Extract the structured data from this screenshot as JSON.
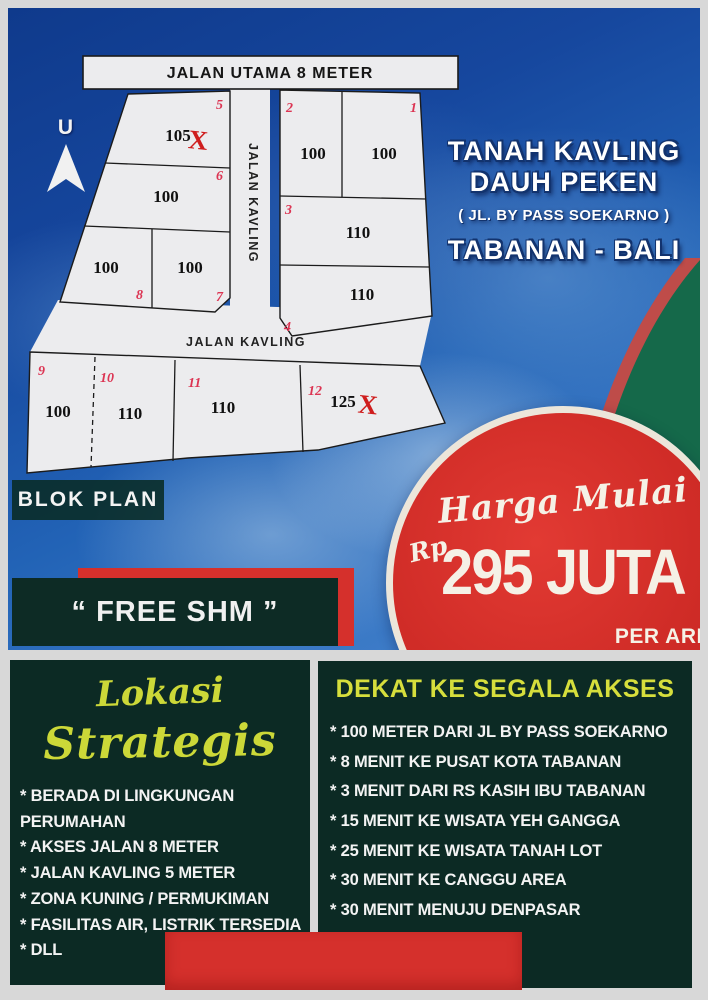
{
  "map": {
    "north_label": "U",
    "main_road_label": "JALAN UTAMA 8 METER",
    "vertical_road_label": "JALAN KAVLING",
    "horizontal_road_label": "JALAN KAVLING",
    "blok_plan_label": "BLOK PLAN",
    "sold_mark": "X",
    "plots": [
      {
        "id": "1",
        "area": "100",
        "sold": false
      },
      {
        "id": "2",
        "area": "100",
        "sold": false
      },
      {
        "id": "3",
        "area": "110",
        "sold": false
      },
      {
        "id": "4",
        "area": "110",
        "sold": false
      },
      {
        "id": "5",
        "area": "105",
        "sold": true
      },
      {
        "id": "6",
        "area": "100",
        "sold": false
      },
      {
        "id": "7",
        "area": "100",
        "sold": false
      },
      {
        "id": "8",
        "area": "100",
        "sold": false
      },
      {
        "id": "9",
        "area": "100",
        "sold": false
      },
      {
        "id": "10",
        "area": "110",
        "sold": false
      },
      {
        "id": "11",
        "area": "110",
        "sold": false
      },
      {
        "id": "12",
        "area": "125",
        "sold": true
      }
    ]
  },
  "headline": {
    "line1": "TANAH KAVLING",
    "line2": "DAUH PEKEN",
    "line3": "( JL. BY PASS SOEKARNO )",
    "line4": "TABANAN - BALI"
  },
  "price": {
    "lead": "Harga Mulai",
    "currency": "Rp",
    "amount": "295 JUTA",
    "unit": "PER ARE"
  },
  "free_shm_label": "“ FREE SHM ”",
  "left_panel": {
    "heading_line1": "Lokasi",
    "heading_line2": "Strategis",
    "items": [
      "* BERADA DI LINGKUNGAN PERUMAHAN",
      "* AKSES JALAN 8 METER",
      "* JALAN KAVLING 5 METER",
      "* ZONA KUNING / PERMUKIMAN",
      "* FASILITAS AIR, LISTRIK TERSEDIA",
      "* DLL"
    ]
  },
  "right_panel": {
    "heading": "DEKAT KE SEGALA AKSES",
    "items": [
      "* 100 METER DARI JL BY PASS SOEKARNO",
      "* 8 MENIT KE PUSAT KOTA TABANAN",
      "* 3 MENIT DARI RS KASIH IBU TABANAN",
      "* 15 MENIT KE WISATA YEH GANGGA",
      "* 25 MENIT KE WISATA TANAH LOT",
      "* 30 MENIT KE CANGGU AREA",
      "* 30 MENIT MENUJU DENPASAR"
    ]
  },
  "colors": {
    "accent_red": "#d5302c",
    "panel_green": "#0c2a24",
    "ribbon_green": "#15694a",
    "highlight_yellow": "#d3dd3a",
    "sky_blue": "#1c55ab"
  }
}
